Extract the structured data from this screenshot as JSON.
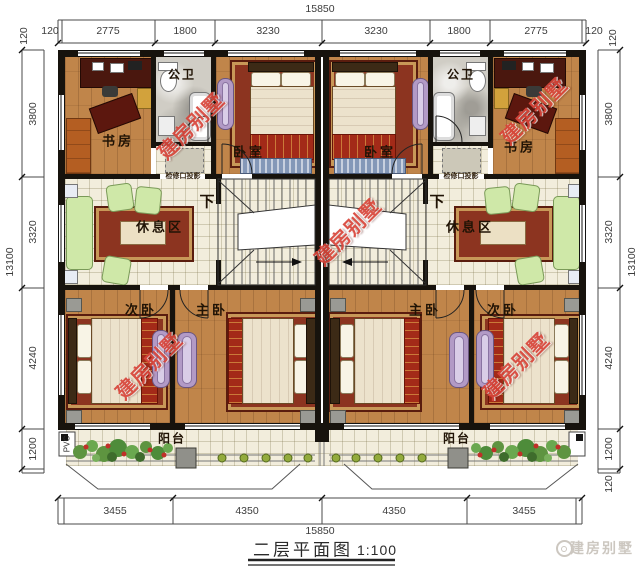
{
  "title": {
    "text": "二层平面图",
    "scale": "1:100"
  },
  "brand": {
    "watermark_text": "建房别墅",
    "footer_logo_text": "建房别墅"
  },
  "rooms": {
    "study": "书房",
    "bathroom": "公卫",
    "bedroom": "卧室",
    "rest_area": "休息区",
    "secondary_bedroom": "次卧",
    "master_bedroom": "主卧",
    "balcony": "阳台"
  },
  "annotations": {
    "down": "下",
    "inspection_opening": "检修口投影",
    "pvc": "PVC"
  },
  "dimensions": {
    "top": {
      "total": "15850",
      "segments": [
        "120",
        "2775",
        "1800",
        "3230",
        "3230",
        "1800",
        "2775",
        "120"
      ]
    },
    "bottom": {
      "total": "15850",
      "segments": [
        "3455",
        "4350",
        "4350",
        "3455"
      ]
    },
    "left": {
      "total": "13100",
      "segments": [
        "3800",
        "3320",
        "4240",
        "1200"
      ],
      "corner_top": "120"
    },
    "right": {
      "total": "13100",
      "segments": [
        "3800",
        "3320",
        "4240",
        "1200"
      ],
      "corner_top": "120",
      "corner_bottom": "120"
    }
  },
  "colors": {
    "watermark_red": "#d8453a",
    "wall_black": "#17130d",
    "wood_floor": "#c0854a",
    "tile_floor": "#f2eddc",
    "marble_floor": "#d0cdc5",
    "sofa_green": "#cfe8a8",
    "wardrobe_purple": "#b29ac6",
    "rug_red": "#8c3420"
  }
}
